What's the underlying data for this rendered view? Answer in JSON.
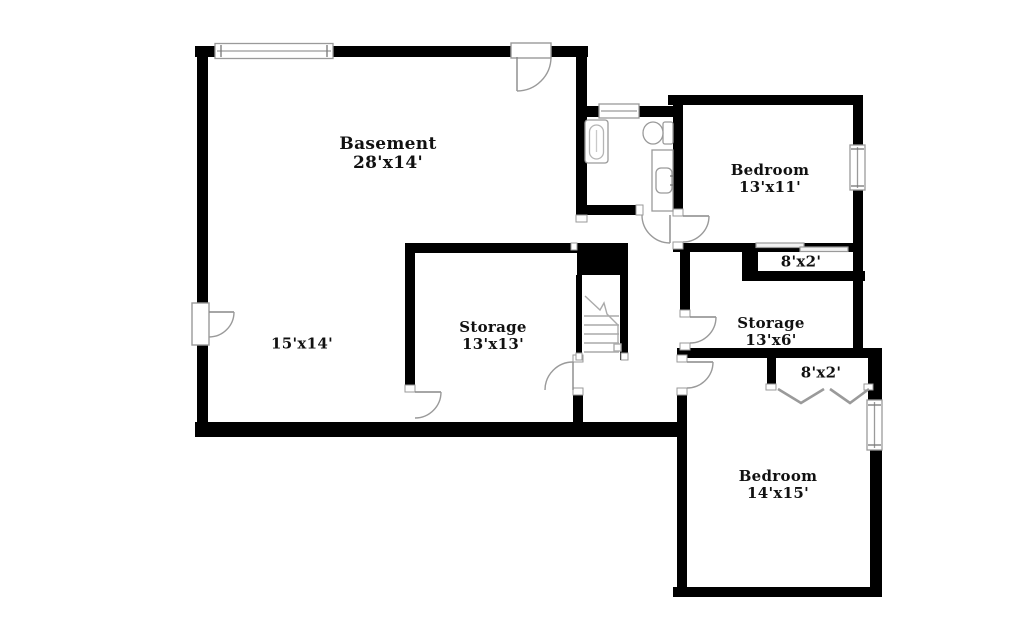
{
  "plan": {
    "background_color": "#ffffff",
    "wall_color": "#000000",
    "outline_color": "#9a9a9a",
    "text_color": "#111111",
    "rooms": {
      "basement": {
        "name": "Basement",
        "dims": "28'x14'"
      },
      "basement_area": {
        "name": "",
        "dims": "15'x14'"
      },
      "storage_13x13": {
        "name": "Storage",
        "dims": "13'x13'"
      },
      "bedroom_13x11": {
        "name": "Bedroom",
        "dims": "13'x11'"
      },
      "closet_upper": {
        "name": "",
        "dims": "8'x2'"
      },
      "storage_13x6": {
        "name": "Storage",
        "dims": "13'x6'"
      },
      "closet_lower": {
        "name": "",
        "dims": "8'x2'"
      },
      "bedroom_14x15": {
        "name": "Bedroom",
        "dims": "14'x15'"
      }
    },
    "fixtures": [
      "bathtub",
      "toilet",
      "sink-vanity",
      "stairs"
    ],
    "features": [
      "windows",
      "hinged-doors",
      "sliding-closet-doors",
      "bifold-closet-doors"
    ]
  }
}
